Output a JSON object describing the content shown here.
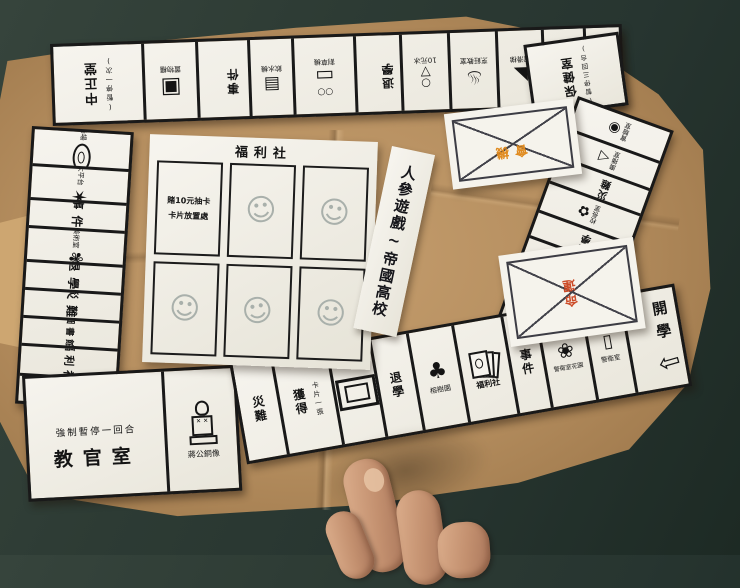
{
  "colors": {
    "accent_orange": "#e08a1e",
    "accent_red": "#cc4b28",
    "paper": "#f5f3ec",
    "kraft": "#b58e5f",
    "table": "#2d3b34",
    "ink": "#191919"
  },
  "icon_glyphs": {
    "locker": "▣",
    "machine": "▤",
    "cart": "▭",
    "wheels": "○○",
    "scoop": "○",
    "cone": "▽",
    "stove": "♨",
    "slide": "◣",
    "microscope": "◉",
    "megaphone": "◁",
    "flowers": "✿",
    "shield": "❂",
    "noodle": "≈",
    "noodle2": "○",
    "window": "⊞",
    "tree": "♣",
    "flower": "❀",
    "door": "▯",
    "star": "✶",
    "palette": "✾",
    "face": "☺",
    "arrow": "⇦"
  },
  "center": {
    "banner": "人參遊戲~帝國高校",
    "welfare_title": "福利社",
    "draw_note_line1": "賭10元抽卡",
    "draw_note_line2": "卡片放置處",
    "chance_label": "機會",
    "destiny_label": "命運"
  },
  "corners": {
    "top_left": {
      "name": "中正堂",
      "note": "(暫停一次)"
    },
    "top_right": {
      "name": "保健室",
      "note": "(暫停三回合)"
    },
    "bottom_left": {
      "name": "教官室",
      "note": "強制暫停一回合"
    },
    "bottom_right": {
      "name": "開學"
    }
  },
  "top_row": [
    {
      "caption": "置物櫃"
    },
    {
      "label": "事件"
    },
    {
      "caption": "飲水機"
    },
    {
      "caption": "割草機"
    },
    {
      "label": "退學"
    },
    {
      "caption": "10元冰"
    },
    {
      "caption": "烹飪教室"
    },
    {
      "caption": "溜滑梯"
    },
    {
      "label": "體育課"
    },
    {
      "label": "災難"
    }
  ],
  "right_col": [
    {
      "caption": "實驗室"
    },
    {
      "caption": "廣播室"
    },
    {
      "label": "災難"
    },
    {
      "caption": "校長室"
    },
    {
      "label": "退學"
    },
    {
      "label": "社團"
    },
    {
      "caption": "學生會"
    },
    {
      "caption": "關東煮"
    },
    {
      "caption": "頂樓"
    }
  ],
  "bottom_row": [
    {
      "caption": "蔣公銅像"
    },
    {
      "label": "災難"
    },
    {
      "label": "獲得",
      "note": "卡片一張"
    },
    {
      "caption": ""
    },
    {
      "label": "退學"
    },
    {
      "caption": "榕樹園"
    },
    {
      "caption": "福利社"
    },
    {
      "label": "事件"
    },
    {
      "caption": "警衛室花園"
    },
    {
      "caption": "警衛室"
    }
  ],
  "left_col": [
    {
      "caption": "操場"
    },
    {
      "caption": "大平台"
    },
    {
      "label": "事件"
    },
    {
      "caption": "美術室"
    },
    {
      "label": "退學"
    },
    {
      "label": "災難"
    },
    {
      "label": "圖書館"
    },
    {
      "label": "福利社"
    },
    {
      "label": "第一間廁所"
    }
  ]
}
